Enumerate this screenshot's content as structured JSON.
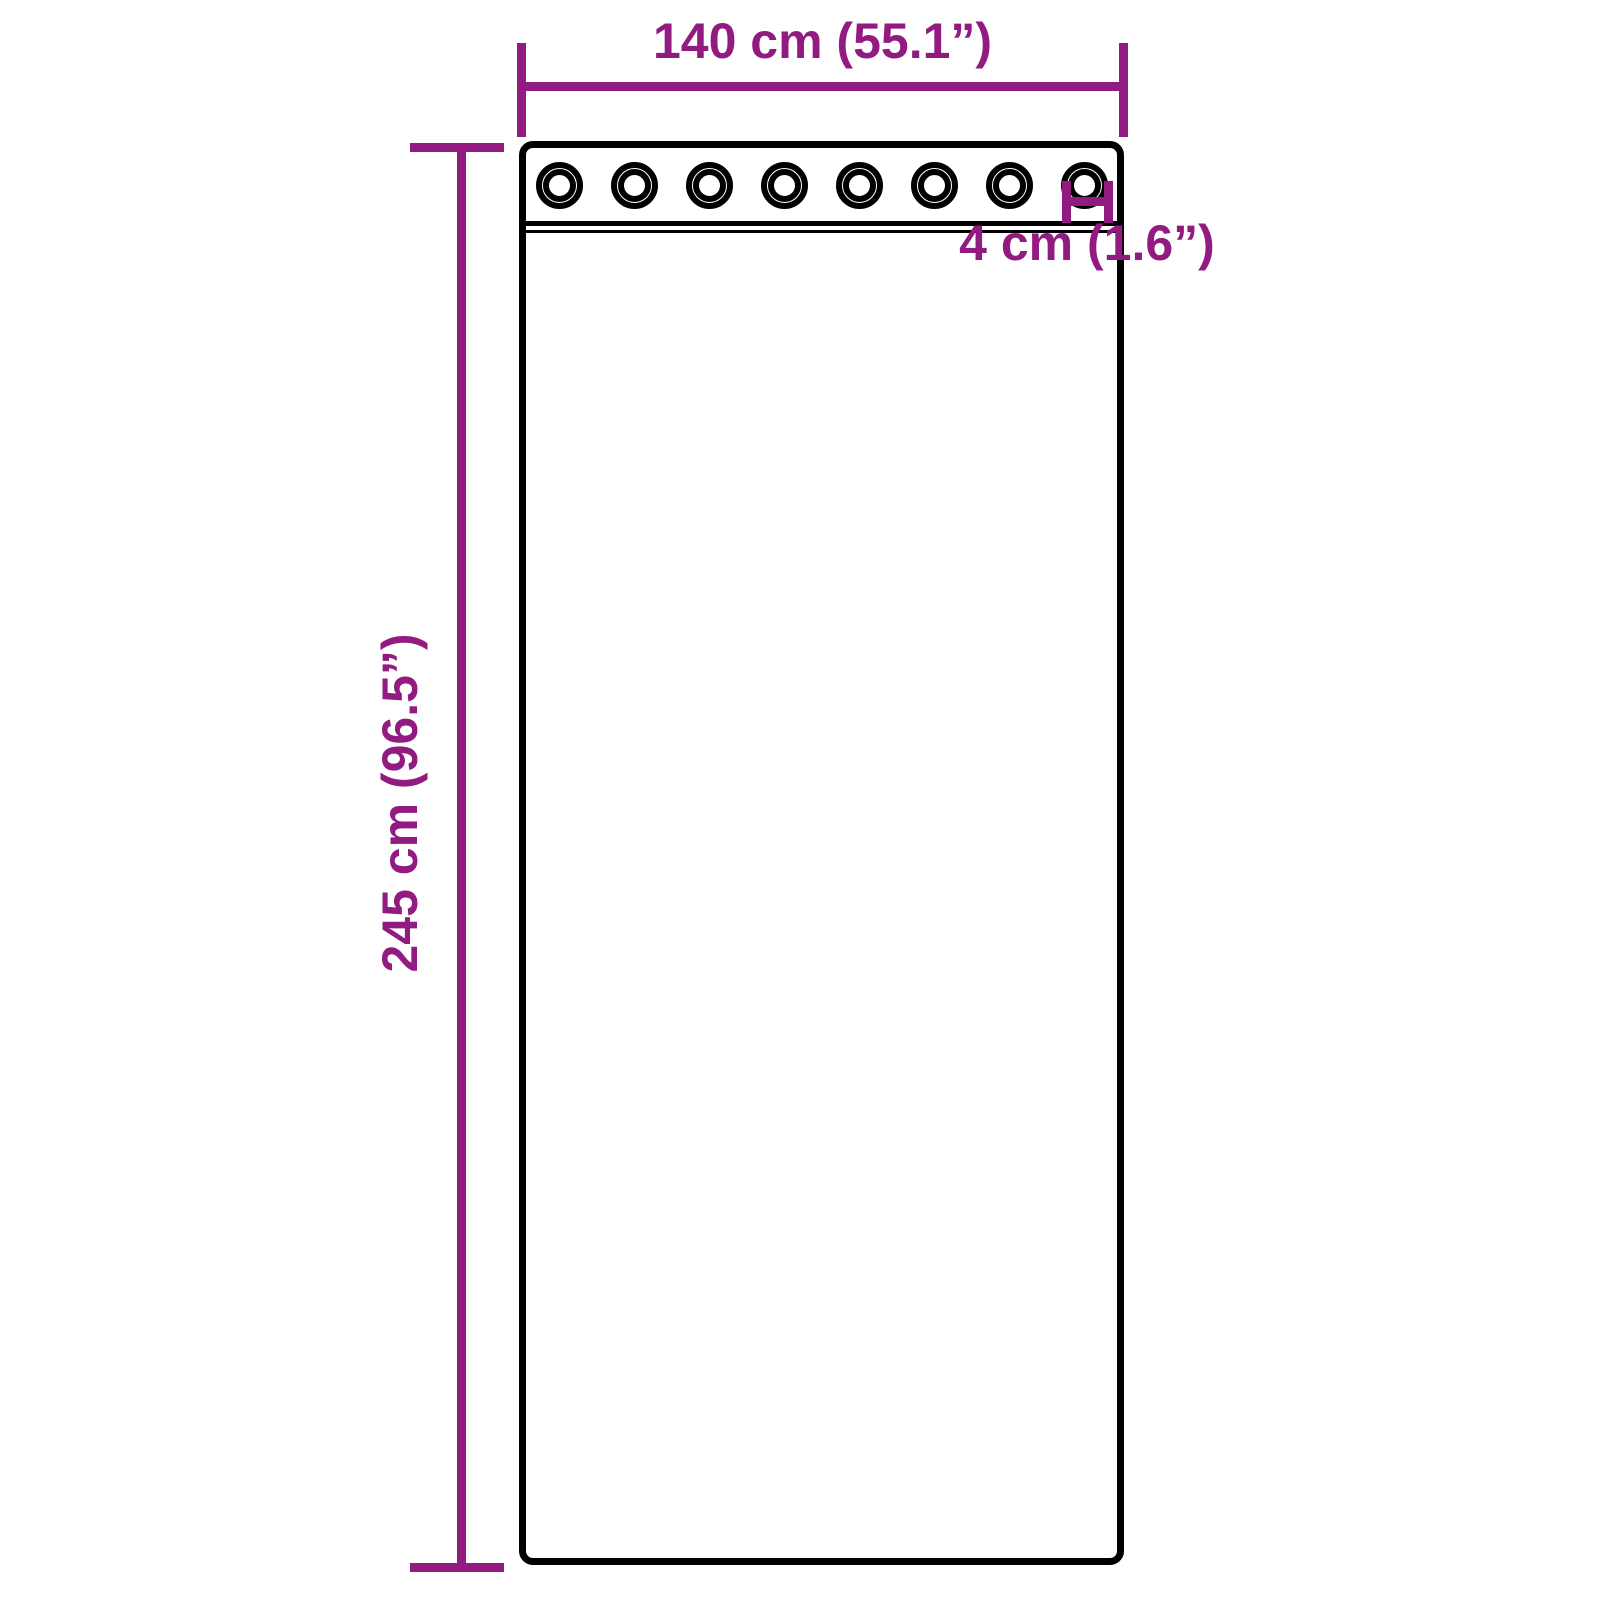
{
  "colors": {
    "dimension_accent": "#911B81",
    "outline": "#000000",
    "background": "#FFFFFF"
  },
  "curtain": {
    "grommet_count": 8
  },
  "dimensions": {
    "width_label": "140 cm (55.1”)",
    "height_label": "245 cm (96.5”)",
    "grommet_label": "4 cm (1.6”)",
    "width_cm": 140,
    "width_in": 55.1,
    "height_cm": 245,
    "height_in": 96.5,
    "grommet_cm": 4,
    "grommet_in": 1.6
  }
}
